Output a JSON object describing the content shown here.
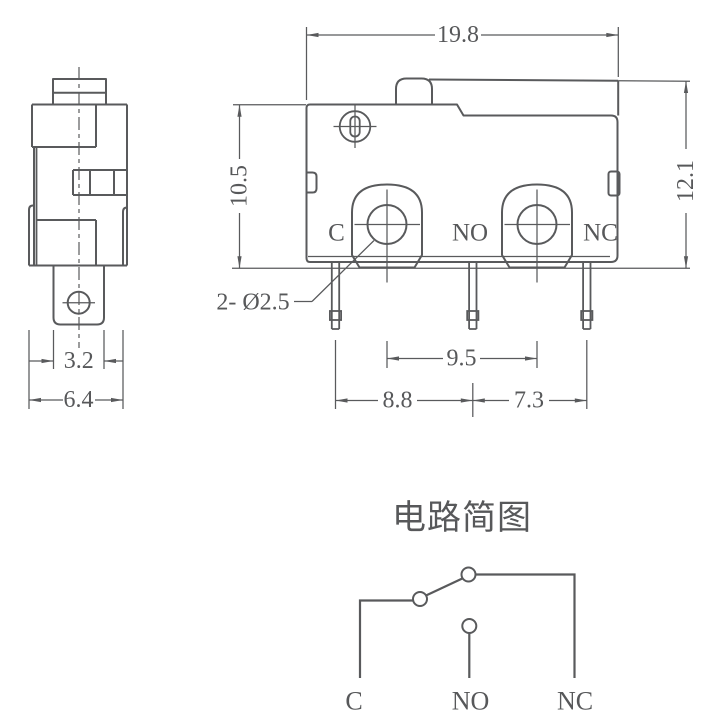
{
  "drawing": {
    "colors": {
      "line": "#595a5c",
      "text": "#57585a",
      "background": "#ffffff"
    },
    "dimensions": {
      "front_width": "19.8",
      "front_height_right": "12.1",
      "front_height_left": "10.5",
      "mount_hole_spacing": "9.5",
      "pin_spacing_left": "8.8",
      "pin_spacing_right": "7.3",
      "side_terminal_width": "3.2",
      "side_body_width": "6.4",
      "hole_callout": "2- Ø2.5"
    },
    "terminals": {
      "common": "C",
      "normally_open": "NO",
      "normally_closed": "NC"
    },
    "circuit": {
      "title": "电路简图",
      "labels": {
        "common": "C",
        "normally_open": "NO",
        "normally_closed": "NC"
      }
    }
  }
}
